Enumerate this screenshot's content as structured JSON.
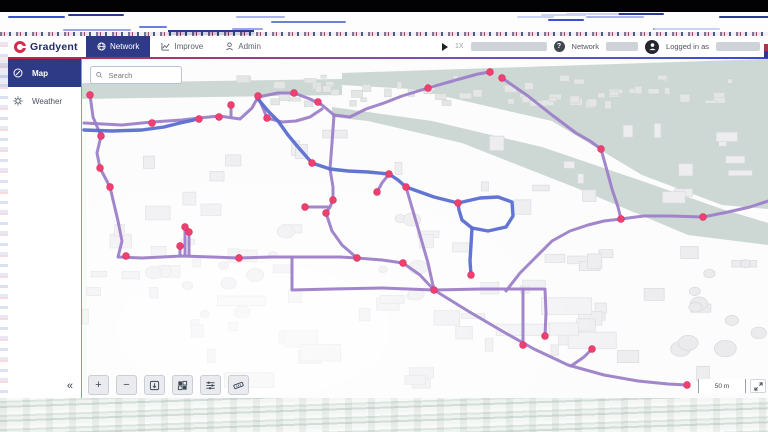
{
  "colors": {
    "navy": "#2e3a85",
    "brand_red": "#d5294d",
    "pipe_purple": "#9d7fc9",
    "pipe_blue": "#5a6ed0",
    "node_pink": "#f0406f",
    "node_ring": "#d82a5e",
    "water": "#cdd7d3",
    "header_border_left": "#c41f3e",
    "header_border_right": "#3b49c9"
  },
  "header": {
    "brand": "Gradyent",
    "tabs": [
      {
        "label": "Network",
        "active": true
      },
      {
        "label": "Improve",
        "active": false
      },
      {
        "label": "Admin",
        "active": false
      }
    ],
    "playback_speed": "1X",
    "help_label": "?",
    "network_label": "Network",
    "login_label": "Logged in as"
  },
  "sidebar": {
    "items": [
      {
        "label": "Map",
        "active": true
      },
      {
        "label": "Weather",
        "active": false
      }
    ],
    "collapse": "«"
  },
  "map": {
    "search_placeholder": "Search",
    "scale_label": "50 m",
    "controls": {
      "zoom_in": "+",
      "zoom_out": "−"
    },
    "water": [
      [
        [
          0,
          24
        ],
        [
          260,
          20
        ],
        [
          260,
          36
        ],
        [
          0,
          40
        ]
      ],
      [
        [
          260,
          14
        ],
        [
          686,
          0
        ],
        [
          686,
          150
        ],
        [
          640,
          146
        ],
        [
          560,
          116
        ],
        [
          470,
          62
        ],
        [
          330,
          30
        ],
        [
          260,
          26
        ]
      ],
      [
        [
          250,
          48
        ],
        [
          350,
          62
        ],
        [
          460,
          88
        ],
        [
          560,
          122
        ],
        [
          640,
          150
        ],
        [
          686,
          164
        ],
        [
          686,
          186
        ],
        [
          606,
          176
        ],
        [
          492,
          128
        ],
        [
          380,
          84
        ],
        [
          286,
          62
        ],
        [
          250,
          58
        ]
      ]
    ],
    "network": {
      "pipes": [
        {
          "type": "purple",
          "d": "M8,36 L11,58 L19,77 L15,94 L18,109 L28,128 L36,162 L40,182 L36,198 L60,199 L100,197 L130,198 L157,199 L190,198 L228,198 L258,198 L275,199 L300,201 L321,204 L338,216 L352,231"
        },
        {
          "type": "purple",
          "d": "M2,64 L40,66 L70,63 L100,61 L117,59 L137,57 L158,60 L170,49 L176,38 L196,34 L212,34 L228,40 L240,46 L252,56 L268,58 L284,50 L302,44 L320,37 L346,29 L374,21 L396,15 L408,13"
        },
        {
          "type": "purple",
          "d": "M176,38 L181,49 L185,59 L200,63 L214,62 L228,58 L240,50"
        },
        {
          "type": "purple",
          "d": "M149,57 L149,46"
        },
        {
          "type": "purple",
          "d": "M252,56 L250,84 L248,110 L251,128 L251,141 L248,148 L244,154 L250,172 L260,186 L275,199"
        },
        {
          "type": "purple",
          "d": "M246,148 L223,148"
        },
        {
          "type": "purple",
          "d": "M307,115 L300,124 L295,133"
        },
        {
          "type": "purple",
          "d": "M324,128 L331,152 L338,176 L346,204 L352,231"
        },
        {
          "type": "purple",
          "d": "M210,198 L210,231 L250,230 L300,229 L352,231 L400,230 L441,230 L463,230 L464,254 L463,277"
        },
        {
          "type": "purple",
          "d": "M441,230 L441,262 L441,286"
        },
        {
          "type": "purple",
          "d": "M352,231 L386,252 L420,272 L452,290 L486,306 L522,316 L556,322 L586,325 L605,326"
        },
        {
          "type": "purple",
          "d": "M489,307 L502,298 L510,290"
        },
        {
          "type": "purple",
          "d": "M424,232 L438,214 L454,198 L470,182 L488,172 L506,166 L522,162 L539,160 L562,157 L588,157 L621,158 L646,153 L668,148 L686,142"
        },
        {
          "type": "purple",
          "d": "M420,19 L446,37 L470,56 L494,74 L508,82 L519,90 L524,108 L530,130 L536,148 L539,160"
        },
        {
          "type": "purple",
          "d": "M98,196 L98,187 M103,196 L103,169 M107,196 L107,174"
        },
        {
          "type": "blue",
          "d": "M2,71 L30,72 L60,71 L82,68 L98,64 L112,61"
        },
        {
          "type": "blue",
          "d": "M176,40 L186,52 L196,62 L206,76 L216,88 L230,104 L248,110 L266,112 L286,113 L307,115 L316,121 L324,128 L338,133 L352,138 L364,141 L376,144"
        },
        {
          "type": "blue",
          "d": "M376,144 L398,139 L416,138 L430,143 L431,157 L424,168 L406,172 L390,169 L380,161 L377,151 L376,144"
        },
        {
          "type": "blue",
          "d": "M390,169 L389,186 L388,202 L389,216"
        }
      ],
      "nodes": [
        [
          8,
          36
        ],
        [
          212,
          34
        ],
        [
          176,
          37
        ],
        [
          149,
          46
        ],
        [
          185,
          59
        ],
        [
          117,
          60
        ],
        [
          137,
          58
        ],
        [
          70,
          64
        ],
        [
          19,
          77
        ],
        [
          18,
          109
        ],
        [
          28,
          128
        ],
        [
          223,
          148
        ],
        [
          103,
          168
        ],
        [
          107,
          173
        ],
        [
          98,
          187
        ],
        [
          44,
          197
        ],
        [
          157,
          199
        ],
        [
          230,
          104
        ],
        [
          307,
          115
        ],
        [
          324,
          128
        ],
        [
          295,
          133
        ],
        [
          251,
          141
        ],
        [
          244,
          154
        ],
        [
          376,
          144
        ],
        [
          275,
          199
        ],
        [
          321,
          204
        ],
        [
          539,
          160
        ],
        [
          621,
          158
        ],
        [
          389,
          216
        ],
        [
          463,
          277
        ],
        [
          441,
          286
        ],
        [
          510,
          290
        ],
        [
          605,
          326
        ],
        [
          519,
          90
        ],
        [
          408,
          13
        ],
        [
          346,
          29
        ],
        [
          236,
          43
        ],
        [
          420,
          19
        ],
        [
          352,
          231
        ]
      ]
    }
  }
}
